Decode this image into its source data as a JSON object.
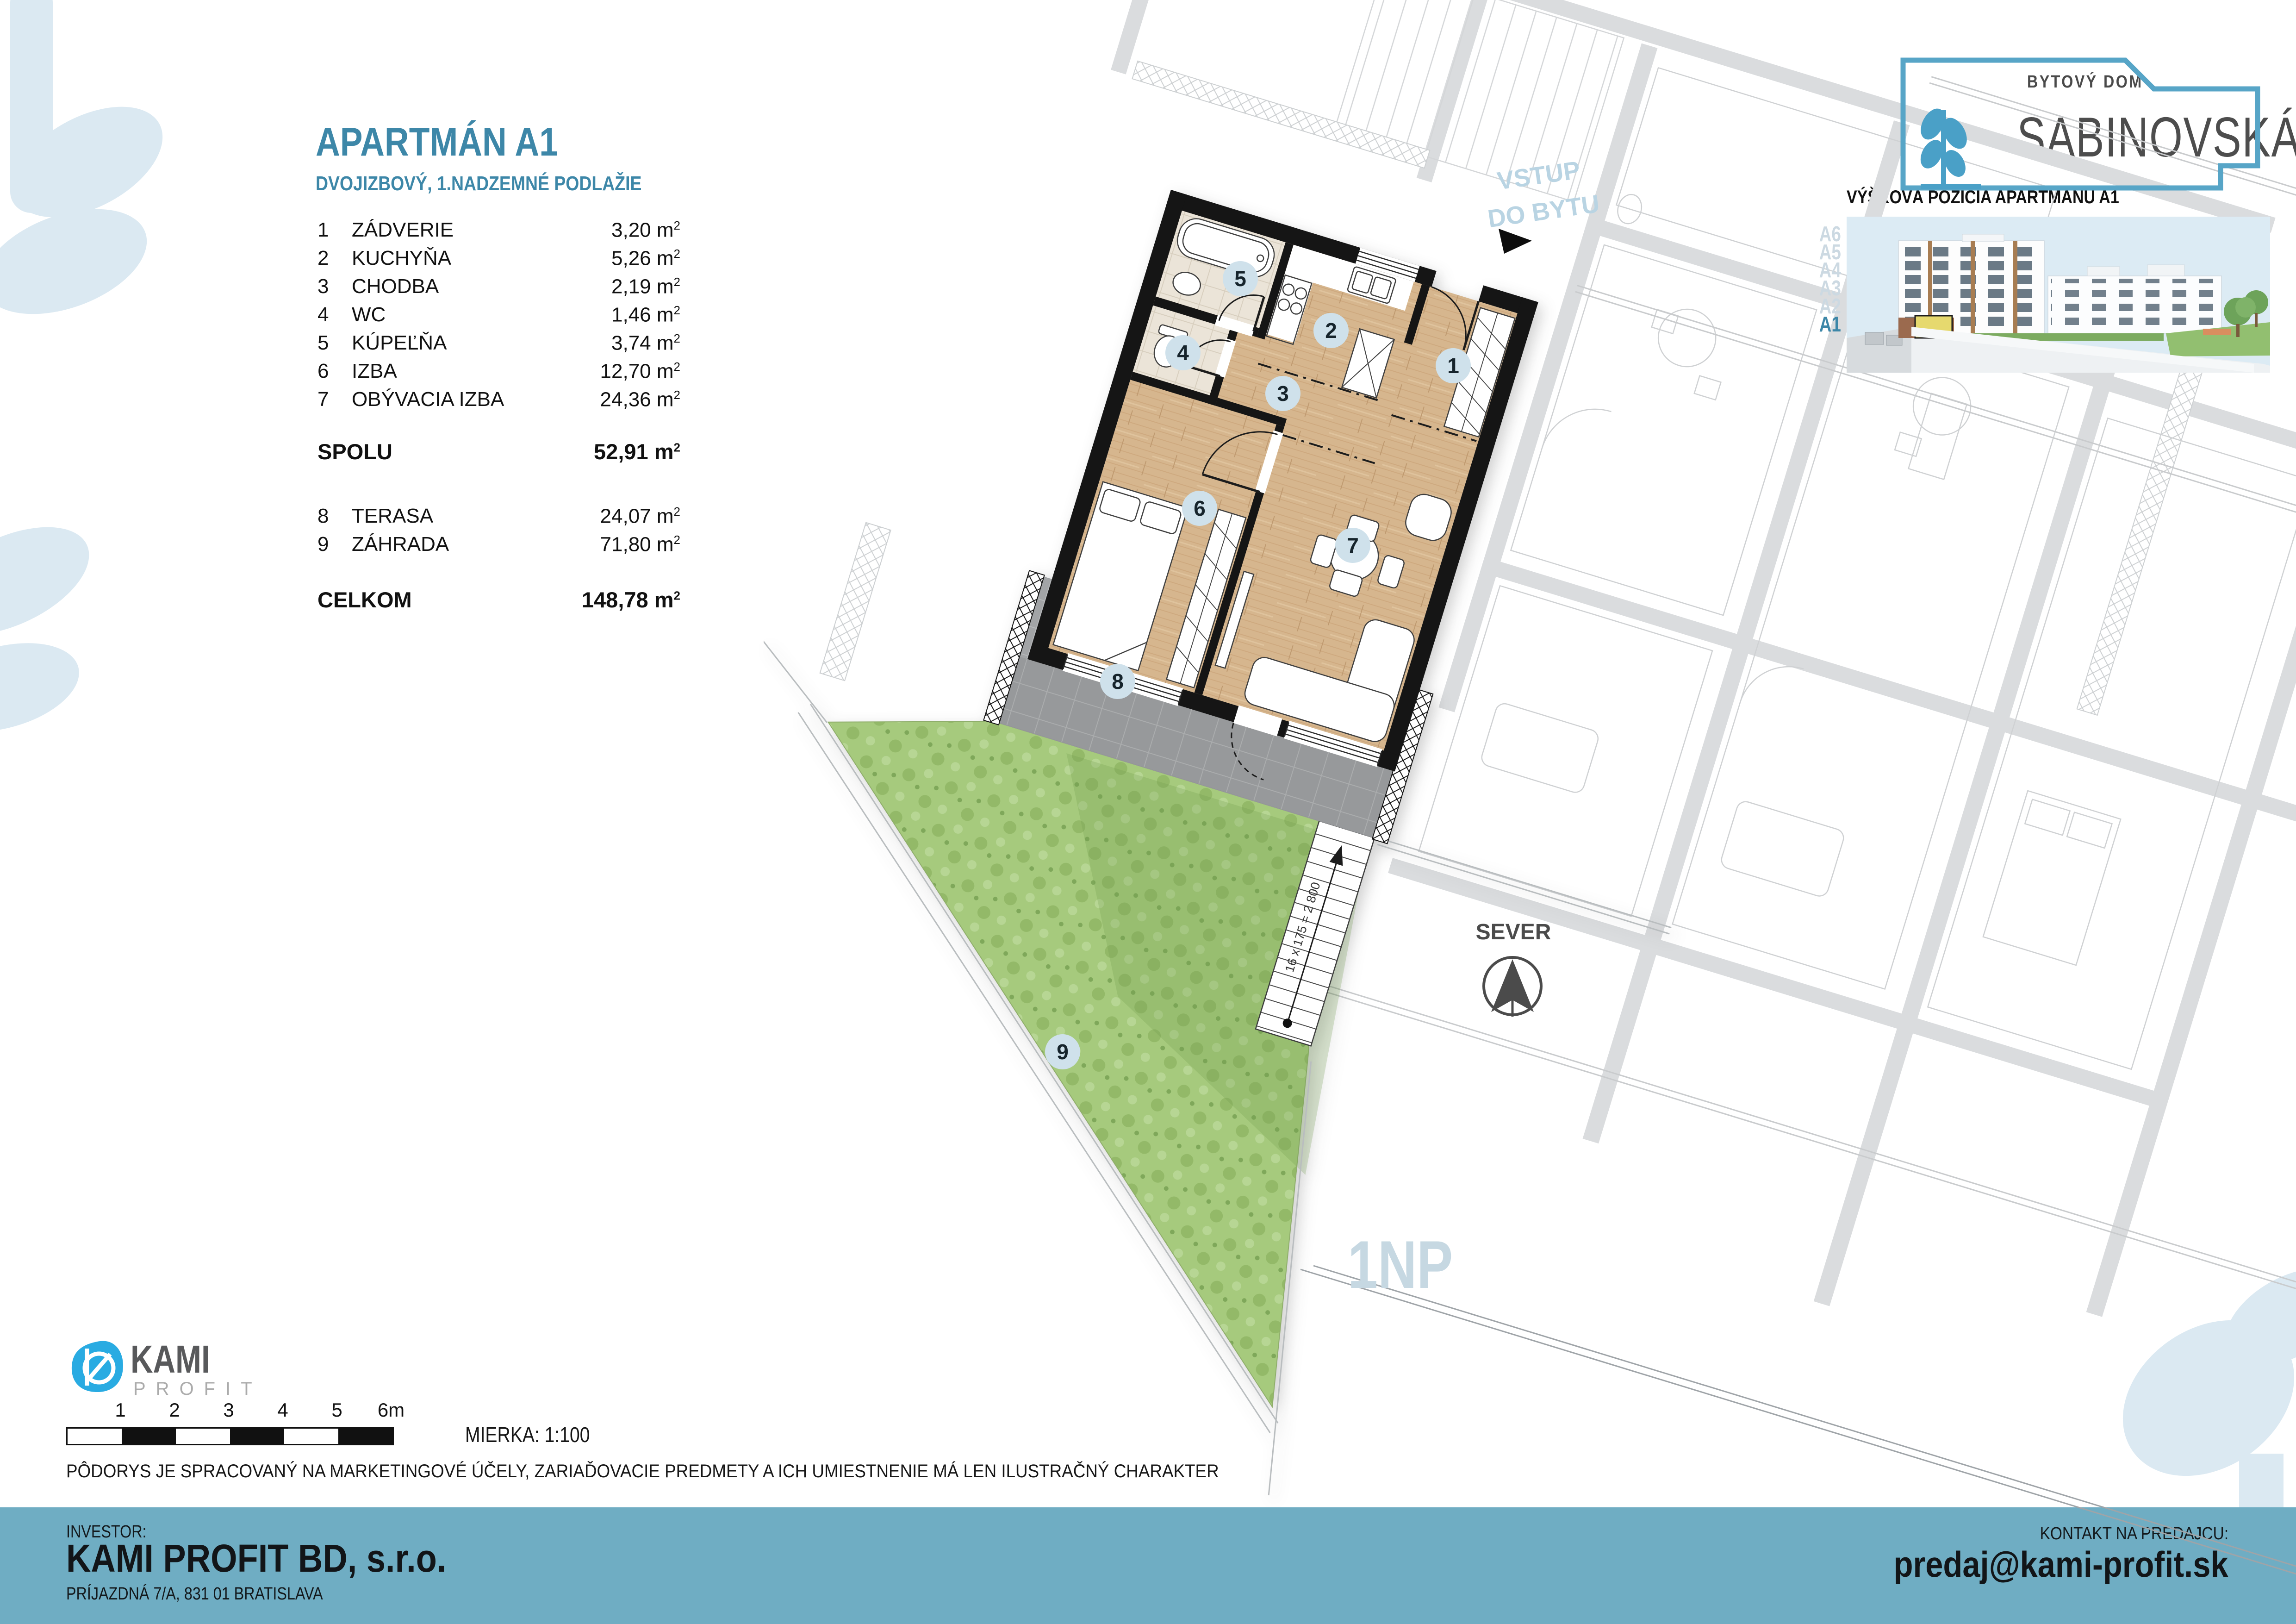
{
  "title": {
    "main": "APARTMÁN A1",
    "subtitle": "DVOJIZBOVÝ, 1.NADZEMNÉ PODLAŽIE"
  },
  "area_table": {
    "unit": "m",
    "sup": "2",
    "rooms": [
      {
        "num": "1",
        "label": "ZÁDVERIE",
        "area": "3,20"
      },
      {
        "num": "2",
        "label": "KUCHYŇA",
        "area": "5,26"
      },
      {
        "num": "3",
        "label": "CHODBA",
        "area": "2,19"
      },
      {
        "num": "4",
        "label": "WC",
        "area": "1,46"
      },
      {
        "num": "5",
        "label": "KÚPEĽŇA",
        "area": "3,74"
      },
      {
        "num": "6",
        "label": "IZBA",
        "area": "12,70"
      },
      {
        "num": "7",
        "label": "OBÝVACIA IZBA",
        "area": "24,36"
      }
    ],
    "outdoor": [
      {
        "num": "8",
        "label": "TERASA",
        "area": "24,07"
      },
      {
        "num": "9",
        "label": "ZÁHRADA",
        "area": "71,80"
      }
    ],
    "spolu_label": "SPOLU",
    "spolu_area": "52,91",
    "celkom_label": "CELKOM",
    "celkom_area": "148,78"
  },
  "brand": {
    "top": "BYTOVÝ DOM",
    "name": "SABINOVSKÁ"
  },
  "elevation": {
    "title": "VÝŠKOVÁ POZÍCIA APARTMÁNU A1",
    "floors": [
      "A6",
      "A5",
      "A4",
      "A3",
      "A2",
      "A1"
    ],
    "highlighted_floor": "A1"
  },
  "plan": {
    "badges": [
      "1",
      "2",
      "3",
      "4",
      "5",
      "6",
      "7",
      "8",
      "9"
    ],
    "entry_label_line1": "VSTUP",
    "entry_label_line2": "DO BYTU",
    "stairs_label": "16 x 175 = 2 800",
    "north_label": "SEVER",
    "floor_label": "1NP"
  },
  "scale": {
    "ticks": [
      "1",
      "2",
      "3",
      "4",
      "5",
      "6m"
    ],
    "label": "MIERKA: 1:100"
  },
  "disclaimer": "PÔDORYS JE SPRACOVANÝ NA MARKETINGOVÉ ÚČELY, ZARIAĎOVACIE PREDMETY A ICH UMIESTNENIE MÁ LEN ILUSTRAČNÝ CHARAKTER",
  "footer": {
    "investor_label": "INVESTOR:",
    "company": "KAMI PROFIT BD, s.r.o.",
    "address": "PRÍJAZDNÁ 7/A, 831 01 BRATISLAVA",
    "contact_label": "KONTAKT NA PREDAJCU:",
    "email": "predaj@kami-profit.sk"
  },
  "kami": {
    "name": "KAMI",
    "sub": "PROFIT"
  },
  "colors": {
    "accent": "#3d87a8",
    "footer_bar": "#6fadc3",
    "badge_bg": "#cfe1eb",
    "entry_text": "#b9d4e3",
    "kami_blue": "#29abe2",
    "highlight_yellow": "#e6d96e",
    "watermark_blue": "#dbe9f2",
    "wood": "#d6b68e",
    "grass": "#a6ca7d",
    "terrace": "#a2a4a6"
  }
}
